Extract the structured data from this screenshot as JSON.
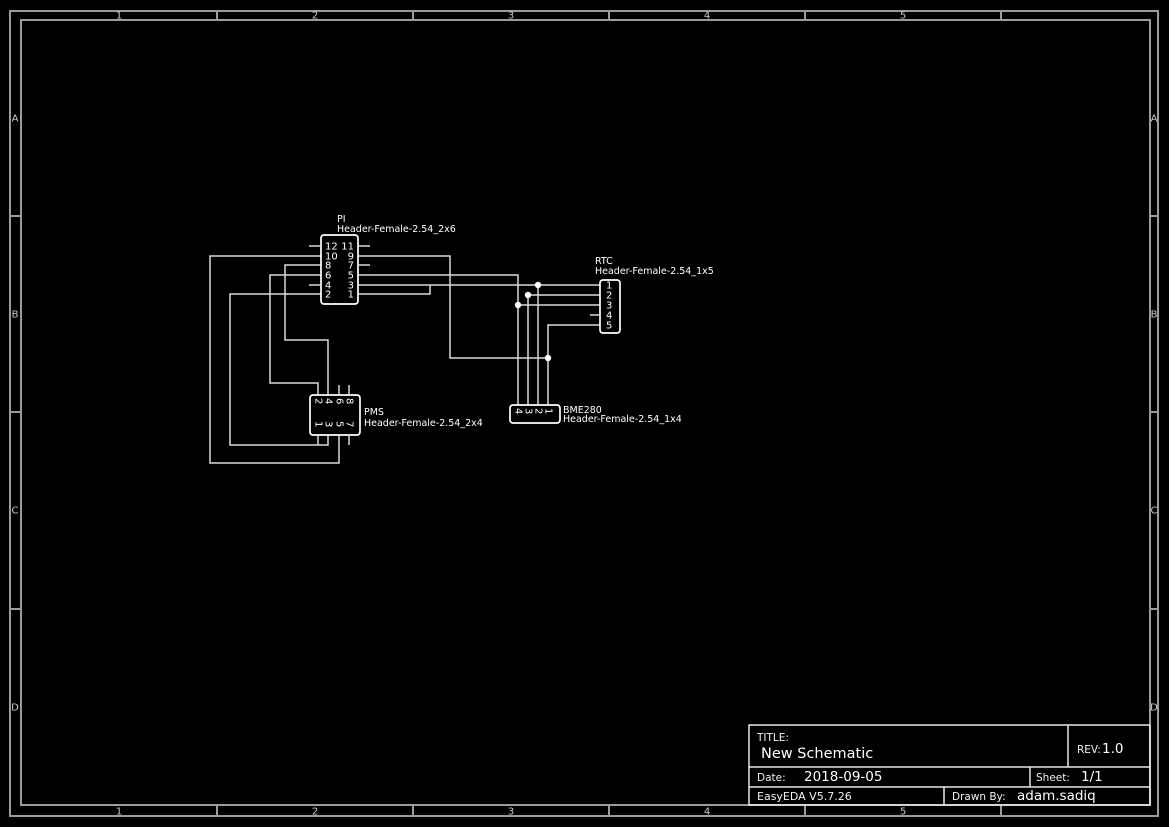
{
  "frame": {
    "columns": [
      "1",
      "2",
      "3",
      "4",
      "5"
    ],
    "rows": [
      "A",
      "B",
      "C",
      "D"
    ]
  },
  "title_block": {
    "title_label": "TITLE:",
    "title": "New Schematic",
    "rev_label": "REV:",
    "rev": "1.0",
    "date_label": "Date:",
    "date": "2018-09-05",
    "sheet_label": "Sheet:",
    "sheet": "1/1",
    "software": "EasyEDA V5.7.26",
    "drawn_by_label": "Drawn By:",
    "drawn_by": "adam.sadiq"
  },
  "components": {
    "pi": {
      "ref": "PI",
      "footprint": "Header-Female-2.54_2x6",
      "left_pins": [
        "12",
        "10",
        "8",
        "6",
        "4",
        "2"
      ],
      "right_pins": [
        "11",
        "9",
        "7",
        "5",
        "3",
        "1"
      ]
    },
    "pms": {
      "ref": "PMS",
      "footprint": "Header-Female-2.54_2x4",
      "top_pins": [
        "2",
        "4",
        "6",
        "8"
      ],
      "bottom_pins": [
        "1",
        "3",
        "5",
        "7"
      ]
    },
    "rtc": {
      "ref": "RTC",
      "footprint": "Header-Female-2.54_1x5",
      "pins": [
        "1",
        "2",
        "3",
        "4",
        "5"
      ]
    },
    "bme280": {
      "ref": "BME280",
      "footprint": "Header-Female-2.54_1x4",
      "pins": [
        "4",
        "3",
        "2",
        "1"
      ]
    }
  },
  "colors": {
    "background": "#000000",
    "wire": "#d9d9d9",
    "component_outline": "#ffffff",
    "frame": "#9b9b9b",
    "junction": "#ffffff"
  }
}
